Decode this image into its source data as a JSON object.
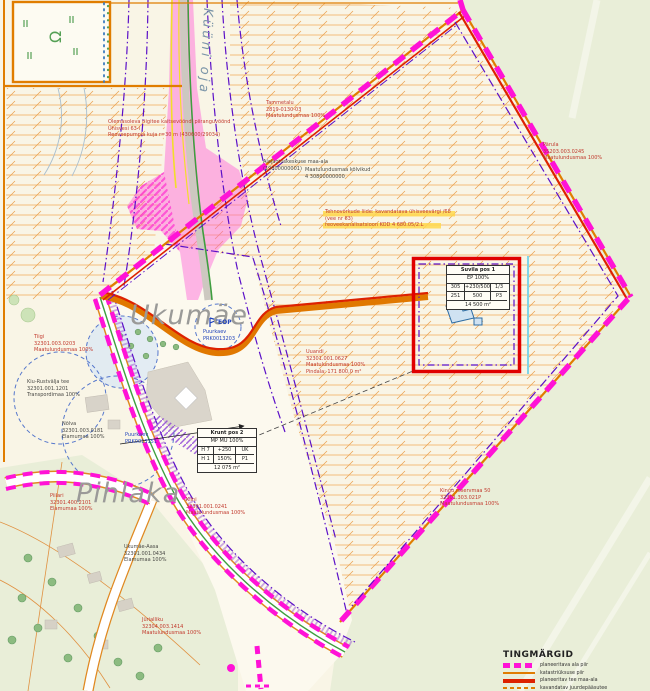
{
  "colors": {
    "planning_boundary_magenta": "#ff12d6",
    "cadastral_orange": "#e07d00",
    "planned_object_red": "#dd2200",
    "utility_purple": "#5b10c8",
    "hatch_orange": "#f2ab58",
    "green_area": "#e9eed8"
  },
  "places": {
    "stream": "Küüni oja",
    "ukumae": "Ukumäe",
    "pihlaka": "Pihlaka"
  },
  "annotations": {
    "a1": "Olemasoleva riigitee kaitsevööndi piiranguvöönd\nÜhisvesi 63-i\nReoveepumpla kuja r=30 m (430600/29034)",
    "a2": "Alajaotuskeskuse maa-ala\n(19800000001)",
    "a3": "Maatulundusmaa kõlvikud\n4 30800000000",
    "a4": "Tehnovõrkude liide: kavandatava ühisveevärgi /68\n(vee nr 63)\nreoveekanalisatsioon KOD 4 680.05/2.L",
    "a5": "Tammetalu\n2819-0130-03\nMaatulundusmaa 100%",
    "a6": "Pärula\n35203.003.0245\nMaatulundusmaa 100%",
    "a7": "Uuandi\n32301.001.0627\nMaatulundusmaa 100%\nPindala: 171 800,0 m²",
    "a8": "Tiigi\n32301.003.0203\nMaatulundusmaa 100%",
    "a9": "Kiu-Rustvälja tee\n32301.001.1201\nTranspordimaa 100%",
    "a10": "Nõlva\n32301.003.0181\nElamumaa 100%",
    "a11": "Puurkaev\nPRK0013151",
    "a12": "Piilari\n32301.400.2101\nElamumaa 100%",
    "a13": "Kiini\n32301.001.0241\nMaatulundusmaa 100%",
    "a14": "Ukumäe-Aasa\n32301.001.0434\nElamumaa 100%",
    "a15": "Jürialliku\n32304.003.1414\nMaatulundusmaa 100%",
    "a16": "Kingu reservmaa 50\n32301.303.021P\nMaatulundusmaa 100%",
    "eop": "EOP",
    "eop_sub": "Puurkaev\nPRK0013203"
  },
  "tables": {
    "krunt2": {
      "title": "Krunt pos 2",
      "sub": "MP MU 100%",
      "c11": "H 7",
      "c12": "+250",
      "c13": "UK",
      "c21": "H 1",
      "c22": "150%",
      "c23": "P1",
      "area": "12 075 m²"
    },
    "suvila1": {
      "title": "Suvila pos 1",
      "sub": "EP 100%",
      "c11": "305",
      "c12": "+230/500",
      "c13": "1/3",
      "c21": "251",
      "c22": "500",
      "c23": "P3",
      "area": "14 500 m²"
    }
  },
  "legend": {
    "title": "TINGMÄRGID",
    "items": [
      {
        "label": "planeeritava ala piir"
      },
      {
        "label": "katastriüksuse piir"
      },
      {
        "label": "planeeritav tee maa-ala"
      },
      {
        "label": "kavandatav juurdepääsutee"
      }
    ]
  }
}
